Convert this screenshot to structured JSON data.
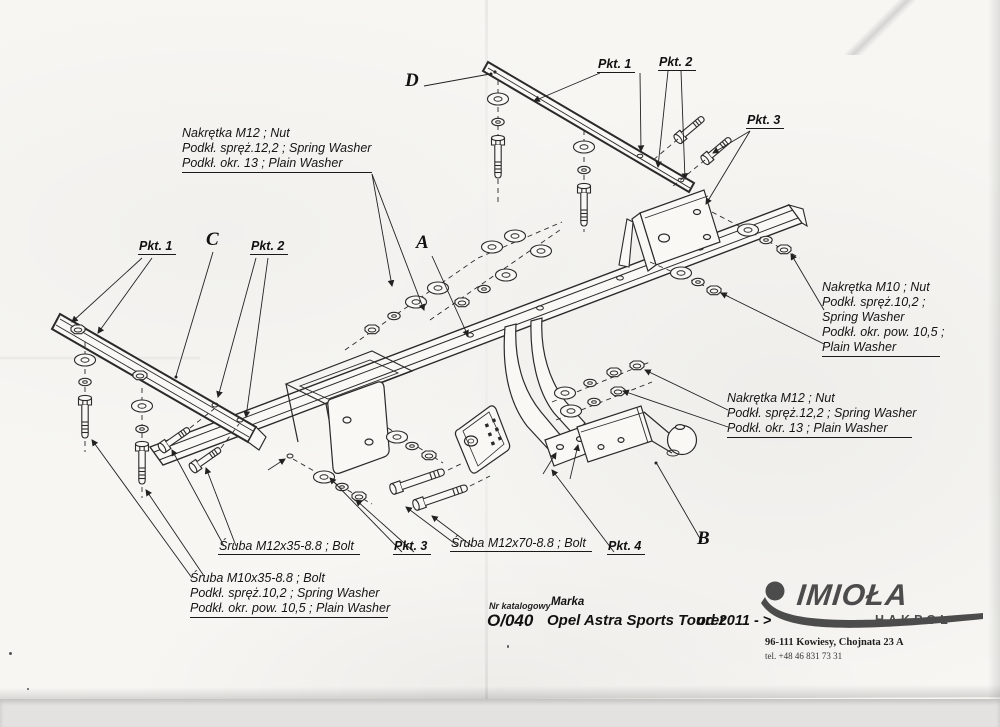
{
  "paper": {
    "background": "#f7f6f3",
    "ink": "#2a2a2a"
  },
  "part_letters": {
    "a": "A",
    "b": "B",
    "c": "C",
    "d": "D"
  },
  "pkt": {
    "top_1": "Pkt. 1",
    "top_2": "Pkt. 2",
    "top_3": "Pkt. 3",
    "left_1": "Pkt. 1",
    "left_2": "Pkt. 2",
    "bottom_3": "Pkt. 3",
    "bottom_4": "Pkt. 4"
  },
  "notes": {
    "top_left": {
      "line1": "Nakrętka  M12 ; Nut",
      "line2": "Podkł. spręż.12,2 ; Spring Washer",
      "line3": "Podkł. okr. 13 ; Plain Washer"
    },
    "right_m10": {
      "line1": "Nakrętka  M10 ; Nut",
      "line2": "Podkł. spręż.10,2 ;",
      "line3": "Spring Washer",
      "line4": "Podkł. okr. pow. 10,5 ;",
      "line5": "Plain Washer"
    },
    "right_m12": {
      "line1": "Nakrętka  M12 ; Nut",
      "line2": "Podkł. spręż.12,2 ; Spring Washer",
      "line3": "Podkł. okr. 13 ; Plain Washer"
    },
    "bottom_left": {
      "line1": "Śruba M10x35-8.8 ;  Bolt",
      "line2": "Podkł. spręż.10,2 ; Spring Washer",
      "line3": "Podkł. okr. pow. 10,5 ; Plain Washer"
    },
    "bolt_m12x35": "Śruba M12x35-8.8 ;  Bolt",
    "bolt_m12x70": "Śruba M12x70-8.8 ;  Bolt"
  },
  "title_block": {
    "catalog_label": "Nr katalogowy",
    "catalog_value": "O/040",
    "make_label": "Marka",
    "make_value": "Opel Astra Sports Tourer",
    "year_range": "od 2011 - >"
  },
  "logo": {
    "brand": "IMIOŁA",
    "division": "HAKPOL",
    "address": "96-111 Kowiesy, Chojnata 23 A",
    "phone": "tel. +48 46 831 73 31"
  }
}
